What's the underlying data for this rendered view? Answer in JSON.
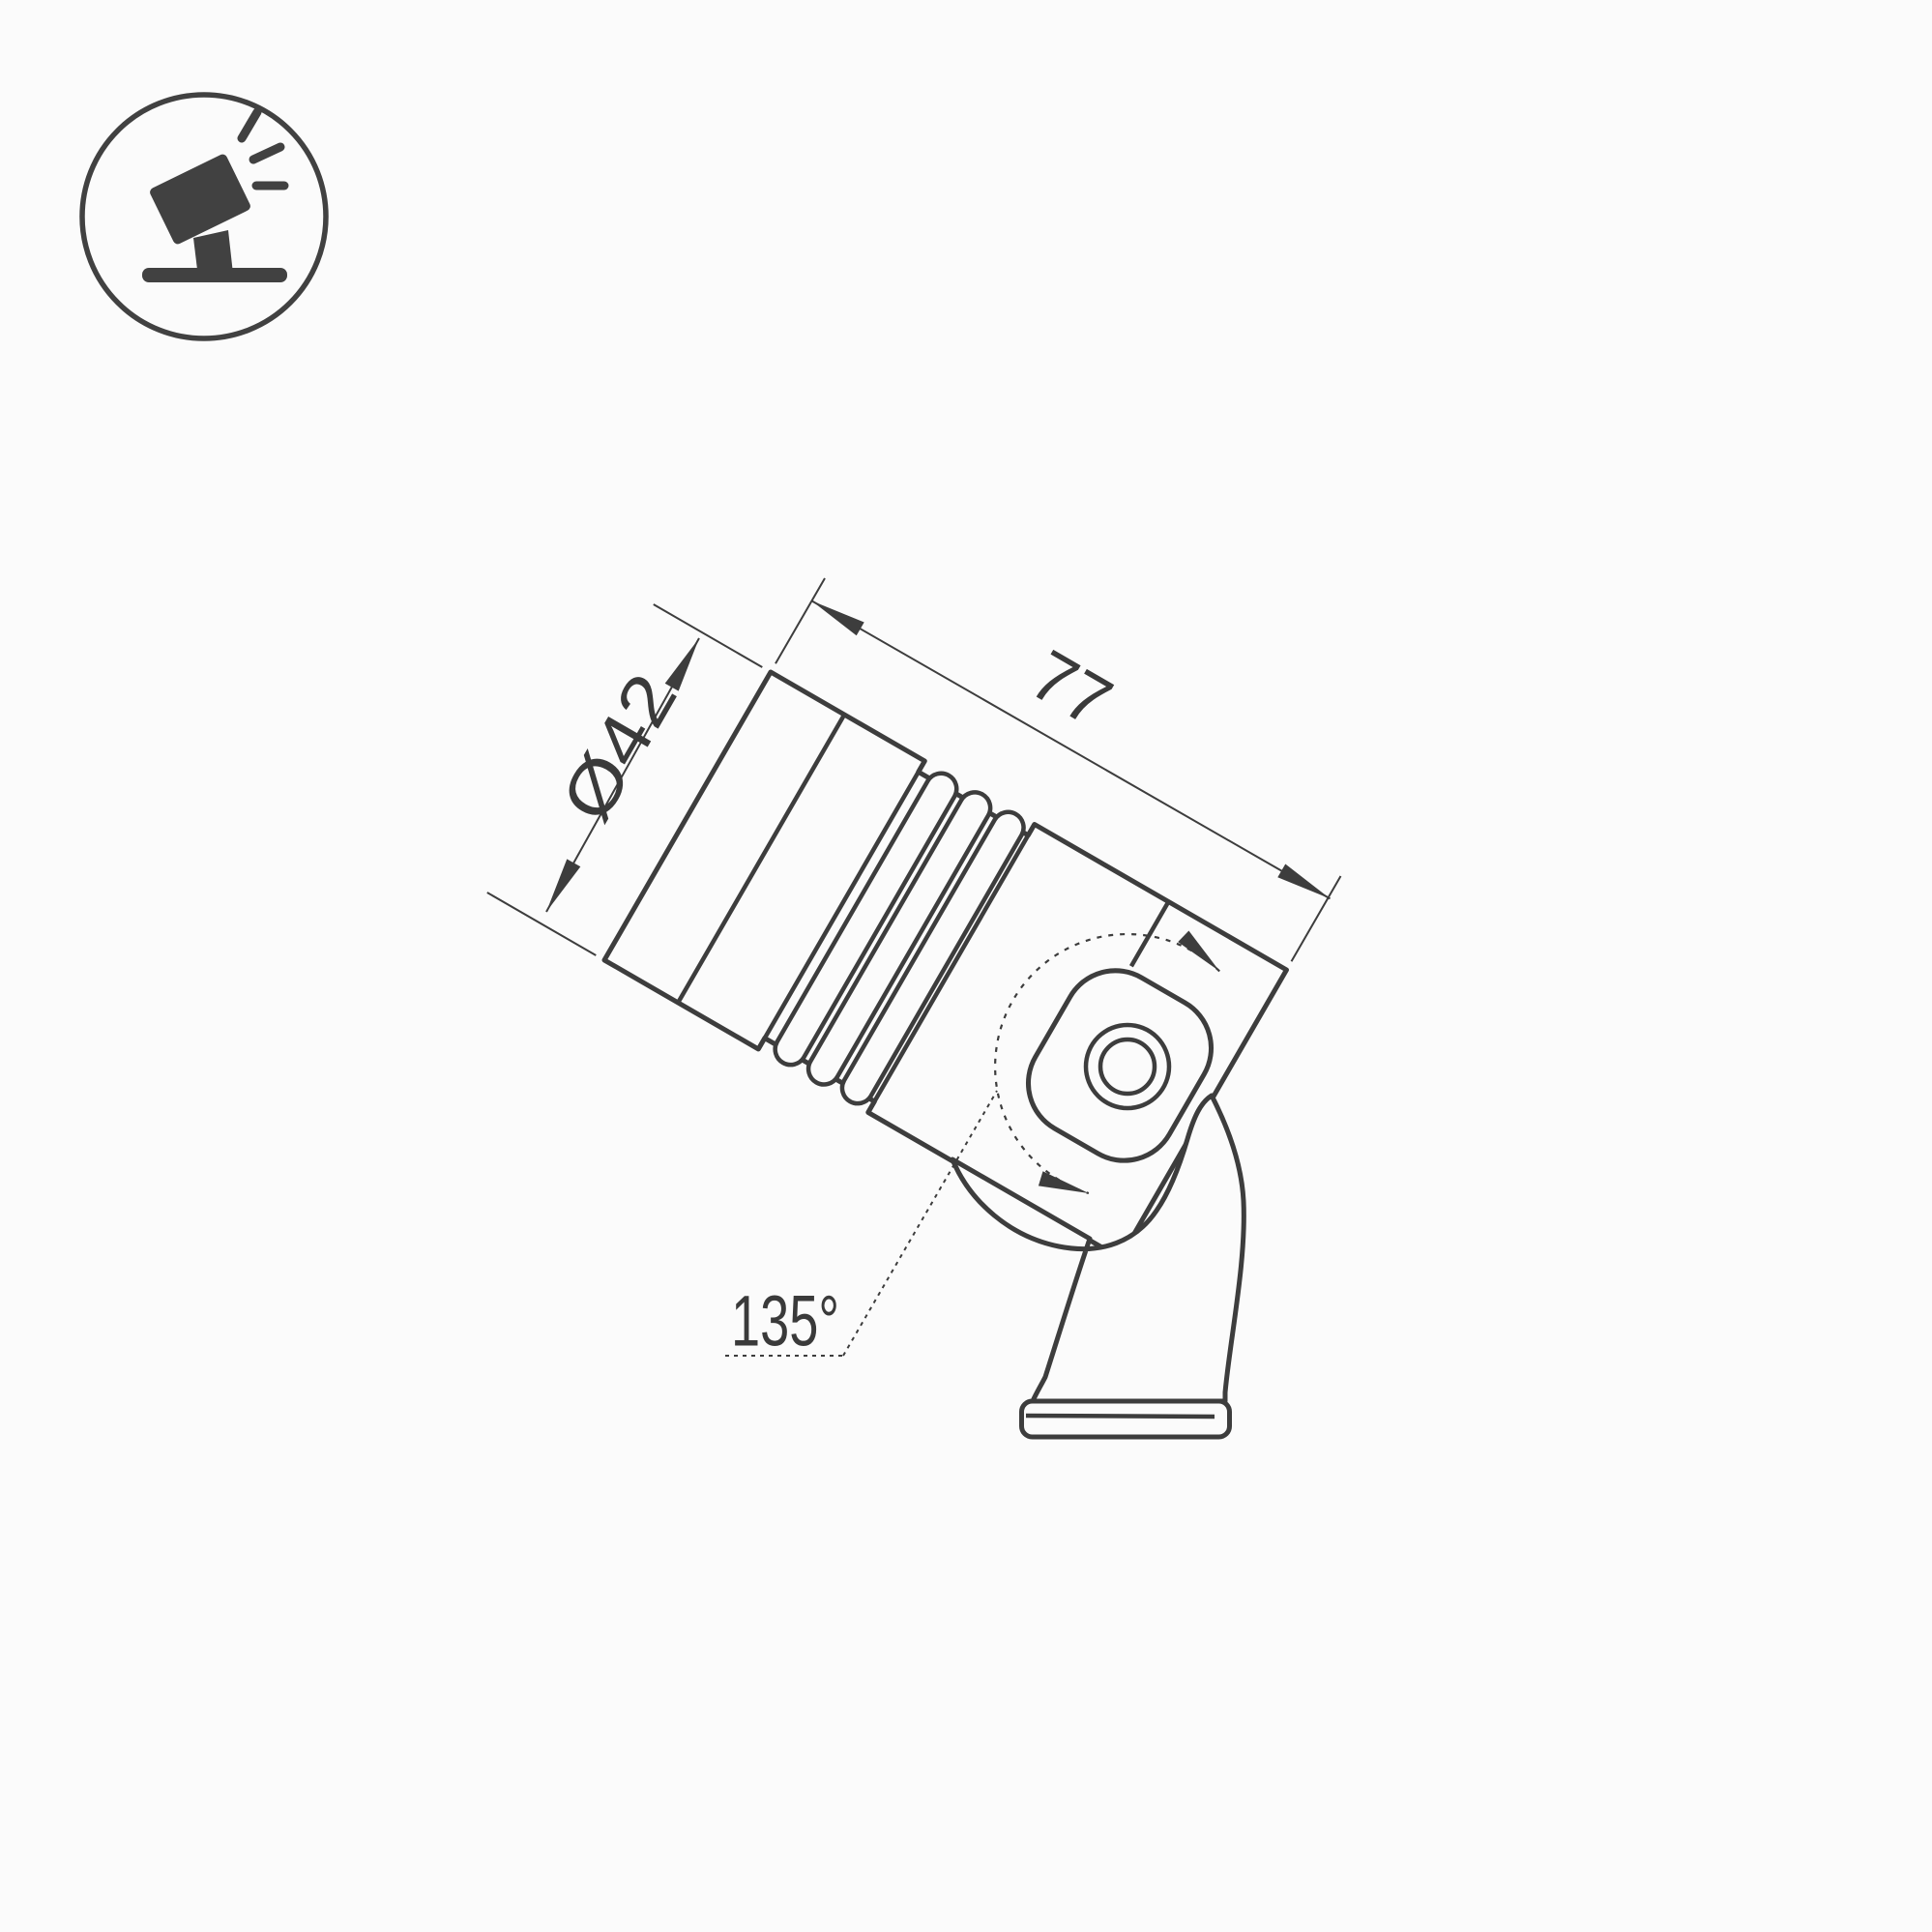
{
  "page": {
    "background": "#fbfbfb",
    "line_color": "#3d3d3d",
    "text_color": "#3a3a3a"
  },
  "icon": {
    "name": "tilted-spotlight-icon",
    "depicts": "spotlight on stand tilted toward upper-right with light rays"
  },
  "drawing": {
    "object": "adjustable spotlight luminaire on swivel mounting bracket",
    "view": "side view, body tilted 30 degrees",
    "dims": {
      "diameter": {
        "label": "Ø42"
      },
      "length": {
        "label": "77"
      },
      "swivel": {
        "label": "135°"
      }
    }
  }
}
